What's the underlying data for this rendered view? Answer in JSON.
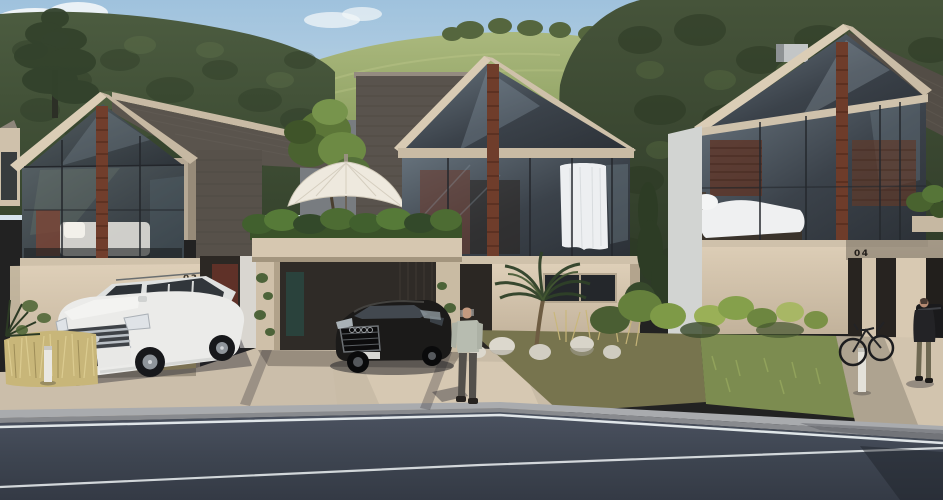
{
  "scene": {
    "title": "Residential street architectural rendering",
    "setting": "Modern gabled houses on a forested hillside street",
    "time_of_day": "day"
  },
  "houses": {
    "left": {
      "number": "03"
    },
    "right": {
      "number": "04"
    }
  },
  "objects": {
    "umbrella": "white patio umbrella",
    "suv": "white SUV parked in driveway",
    "sedan": "black sedan under carport",
    "parked_car": "dark car in carport of house 04",
    "bicycle": "bicycle leaning at house 04",
    "pedestrian_center": "man walking on driveway",
    "pedestrian_right": "man walking toward house 04"
  },
  "palette": {
    "sky_top": "#9fc2dd",
    "sky_bottom": "#d6e3ec",
    "forest_dark": "#39462f",
    "meadow": "#a3b176",
    "wall_beige": "#d7c8b2",
    "wall_shadow": "#57514a",
    "roof_dark": "#5a544d",
    "glass_dark": "#333a41",
    "brick_rust": "#6f3d2b",
    "hedge_green": "#41602e",
    "curtain_white": "#edeff1",
    "suv_white": "#ececea",
    "sedan_black": "#1b1a19",
    "asphalt": "#3a404c",
    "road_line": "#e9eef0",
    "driveway": "#cbbeaa",
    "dry_grass": "#c8b679"
  }
}
